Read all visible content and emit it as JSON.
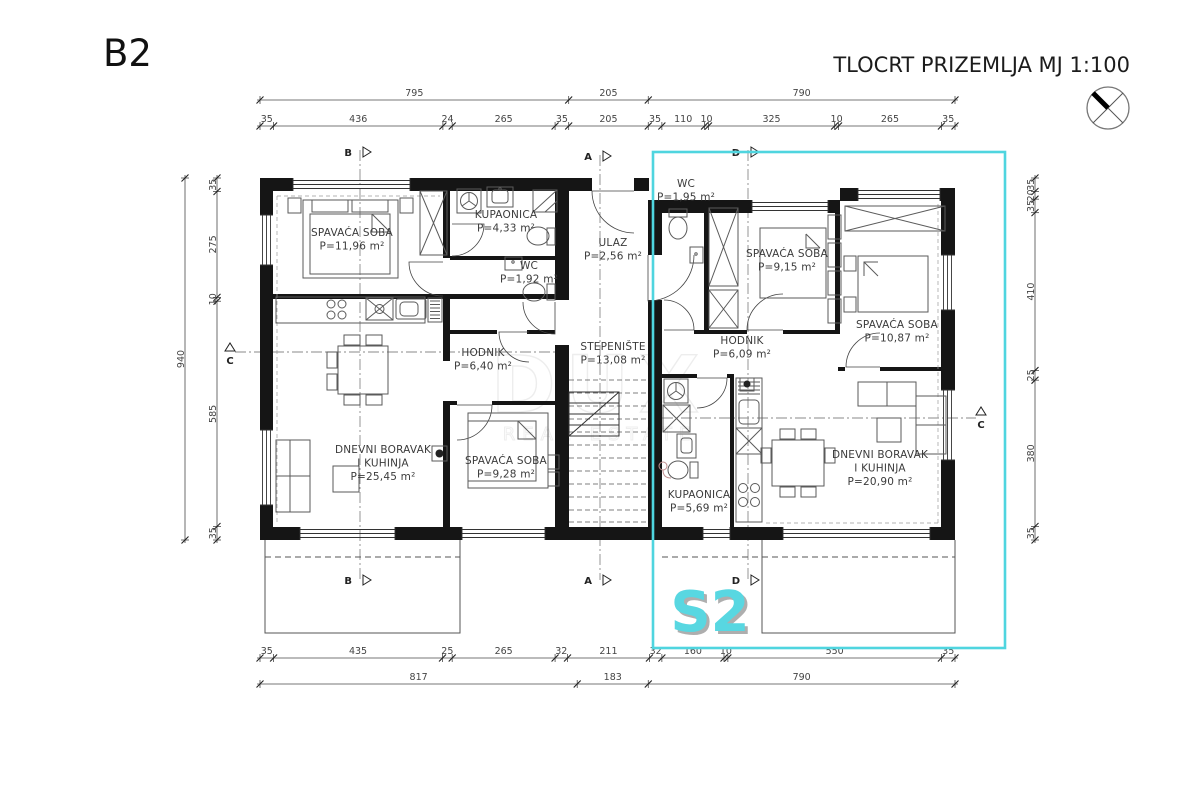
{
  "header": {
    "plan_code": "B2",
    "title": "TLOCRT PRIZEMLJA",
    "scale": "MJ 1:100"
  },
  "overlay": {
    "unit_label": "S2",
    "accent_color": "#4fd5df"
  },
  "watermark": {
    "line1": "DUX",
    "line2": "REAL ESTATE"
  },
  "section_markers": {
    "b": "B",
    "a": "A",
    "c": "C",
    "d": "D"
  },
  "dimensions": {
    "top_overall": [
      795,
      205,
      790
    ],
    "top_detail": [
      35,
      436,
      24,
      265,
      35,
      205,
      35,
      110,
      10,
      325,
      10,
      265,
      35
    ],
    "bottom_detail": [
      35,
      435,
      25,
      265,
      32,
      211,
      32,
      160,
      10,
      550,
      35
    ],
    "bottom_overall": [
      817,
      183,
      790
    ],
    "left_overall": [
      940
    ],
    "left_detail": [
      35,
      275,
      10,
      585,
      35
    ],
    "right_detail": [
      35,
      20,
      35,
      410,
      25,
      380,
      35
    ]
  },
  "rooms": [
    {
      "id": "bedroom-left",
      "lines": [
        "SPAVAĆA SOBA"
      ],
      "area": "P=11,96 m²"
    },
    {
      "id": "bathroom-left",
      "lines": [
        "KUPAONICA"
      ],
      "area": "P=4,33 m²"
    },
    {
      "id": "wc-left",
      "lines": [
        "WC"
      ],
      "area": "P=1,92 m²"
    },
    {
      "id": "ulaz",
      "lines": [
        "ULAZ"
      ],
      "area": "P=2,56 m²"
    },
    {
      "id": "stepeniste",
      "lines": [
        "STEPENIŠTE"
      ],
      "area": "P=13,08 m²"
    },
    {
      "id": "hodnik-left",
      "lines": [
        "HODNIK"
      ],
      "area": "P=6,40 m²"
    },
    {
      "id": "living-left",
      "lines": [
        "DNEVNI BORAVAK",
        "I KUHINJA"
      ],
      "area": "P=25,45 m²"
    },
    {
      "id": "bedroom2-left",
      "lines": [
        "SPAVAĆA SOBA"
      ],
      "area": "P=9,28 m²"
    },
    {
      "id": "wc-right",
      "lines": [
        "WC"
      ],
      "area": "P=1,95 m²"
    },
    {
      "id": "bedroom1-right",
      "lines": [
        "SPAVAĆA SOBA"
      ],
      "area": "P=9,15 m²"
    },
    {
      "id": "bedroom2-right",
      "lines": [
        "SPAVAĆA SOBA"
      ],
      "area": "P=10,87 m²"
    },
    {
      "id": "hodnik-right",
      "lines": [
        "HODNIK"
      ],
      "area": "P=6,09 m²"
    },
    {
      "id": "bathroom-right",
      "lines": [
        "KUPAONICA"
      ],
      "area": "P=5,69 m²"
    },
    {
      "id": "living-right",
      "lines": [
        "DNEVNI BORAVAK",
        "I KUHINJA"
      ],
      "area": "P=20,90 m²"
    }
  ]
}
